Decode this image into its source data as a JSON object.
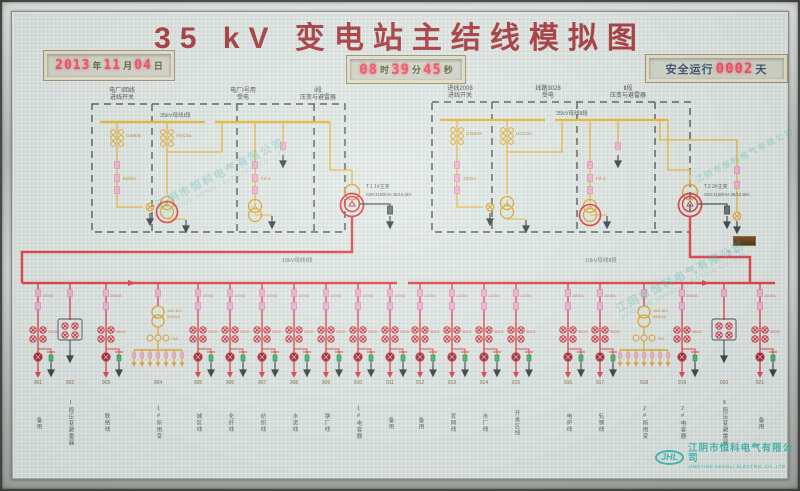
{
  "title": "35 kV 变电站主结线模拟图",
  "displays": {
    "date": {
      "year": "2013",
      "year_unit": "年",
      "month": "11",
      "month_unit": "月",
      "day": "04",
      "day_unit": "日"
    },
    "time": {
      "hour": "08",
      "hour_unit": "时",
      "minute": "39",
      "minute_unit": "分",
      "second": "45",
      "second_unit": "秒"
    },
    "safety": {
      "prefix": "安全运行",
      "days": "0002",
      "suffix": "天"
    }
  },
  "bus35_1": {
    "label": "35kV母线Ⅰ段",
    "headers": [
      [
        "电厂Ⅰ回线",
        "进线开关"
      ],
      [
        "电厂Ⅰ号用",
        "受电"
      ],
      [
        "Ⅰ段",
        "压变与避雷器"
      ]
    ],
    "devices": {
      "switch1": "GW5/B",
      "isolator": "6200A",
      "switch2": "HGC5a",
      "pt": "FZ-1"
    }
  },
  "bus35_2": {
    "label": "35kV母线Ⅱ段",
    "headers": [
      [
        "进线2008",
        "进线开关"
      ],
      [
        "线路3028",
        "受电"
      ],
      [
        "Ⅱ段",
        "压变与避雷器"
      ]
    ],
    "devices": {
      "switch1": "GW5/W",
      "isolator": "3200A",
      "switch2": "HGC5A",
      "pt": "FZ-2"
    }
  },
  "transformers": {
    "t1": {
      "name": "T.1  1#主变",
      "spec": "SZ9-3150kVA 35/10.5kV"
    },
    "t2": {
      "name": "T.2  2#主变",
      "spec": "SZ9-3150kVA 35/10.5kV"
    }
  },
  "lower": {
    "bus1_label": "10kV母线Ⅰ段",
    "bus2_label": "10kV母线Ⅱ段",
    "ct_label": "300/5",
    "station_tx": {
      "spec1": "10/0.4kV",
      "spec2": "500kVA",
      "fuse": "75/5"
    },
    "feeders": [
      {
        "code": "901",
        "name": "备用",
        "amp": "1200A",
        "kind": "std"
      },
      {
        "code": "902",
        "name": "Ⅰ段压变避雷器",
        "amp": "",
        "kind": "pt"
      },
      {
        "code": "903",
        "name": "联络线",
        "amp": "2000A",
        "kind": "std"
      },
      {
        "code": "904",
        "name": "1#所用变",
        "amp": "",
        "kind": "stx"
      },
      {
        "code": "905",
        "name": "城区线",
        "amp": "1200A",
        "kind": "std"
      },
      {
        "code": "906",
        "name": "化纤线",
        "amp": "1200A",
        "kind": "std"
      },
      {
        "code": "907",
        "name": "纺织线",
        "amp": "1200A",
        "kind": "std"
      },
      {
        "code": "908",
        "name": "水泥线",
        "amp": "1200A",
        "kind": "std"
      },
      {
        "code": "909",
        "name": "钢厂线",
        "amp": "1200A",
        "kind": "std"
      },
      {
        "code": "910",
        "name": "1#电容器",
        "amp": "1200A",
        "kind": "std"
      },
      {
        "code": "911",
        "name": "备用",
        "amp": "1200A",
        "kind": "std"
      },
      {
        "code": "912",
        "name": "备用",
        "amp": "1200A",
        "kind": "std"
      },
      {
        "code": "913",
        "name": "农网线",
        "amp": "1200A",
        "kind": "std"
      },
      {
        "code": "914",
        "name": "水厂线",
        "amp": "1200A",
        "kind": "std"
      },
      {
        "code": "915",
        "name": "开发区线",
        "amp": "1200A",
        "kind": "std"
      },
      {
        "code": "916",
        "name": "电炉线",
        "amp": "1200A",
        "kind": "std"
      },
      {
        "code": "917",
        "name": "轧钢线",
        "amp": "1200A",
        "kind": "std"
      },
      {
        "code": "918",
        "name": "2#所用变",
        "amp": "",
        "kind": "stx"
      },
      {
        "code": "919",
        "name": "2#电容器",
        "amp": "2000A",
        "kind": "std"
      },
      {
        "code": "920",
        "name": "Ⅱ段压变避雷器",
        "amp": "",
        "kind": "pt"
      },
      {
        "code": "921",
        "name": "备用",
        "amp": "1200A",
        "kind": "std"
      }
    ]
  },
  "branding": {
    "watermark_cn": "江阴市恒科电气有限公司",
    "watermark_en": "JINGYING HENGLI ELECTRIC CO.,LTD",
    "logo_abbr": "JHL",
    "company_cn": "江阴市恒科电气有限公司",
    "company_en": "JINGYING HENGLI ELECTRIC CO.,LTD"
  },
  "colors": {
    "accent_red": "#e2434b",
    "circuit_yellow": "#e9b633",
    "led_red": "#f04f63",
    "brand_cyan": "#49bdb6",
    "title_red": "#a93a3e"
  }
}
